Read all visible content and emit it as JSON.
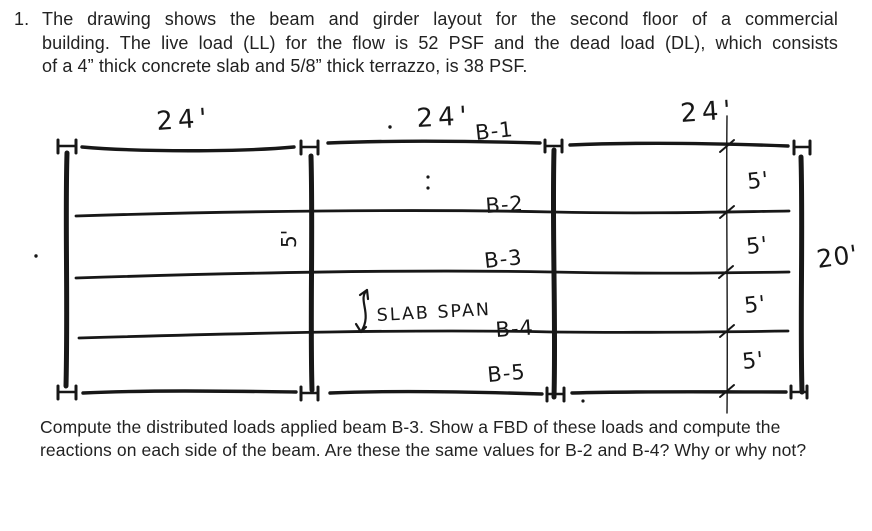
{
  "problem": {
    "number": "1.",
    "lines": [
      "The drawing shows the beam and girder layout for the second floor of a commercial",
      "building.  The live load (LL) for the flow is 52 PSF and the dead load (DL), which consists",
      "of a 4” thick concrete slab and 5/8” thick terrazzo, is 38 PSF."
    ]
  },
  "question": {
    "lines": [
      "Compute the distributed loads applied beam B-3. Show a FBD of these loads and compute the",
      "reactions on each side of the beam.  Are these the same values for B-2 and B-4?  Why or why not?"
    ]
  },
  "diagram": {
    "span_dims": [
      "24'",
      "24'",
      "24'"
    ],
    "beams": [
      "B-1",
      "B-2",
      "B-3",
      "B-4",
      "B-5"
    ],
    "bay_dims": [
      "5'",
      "5'",
      "5'",
      "5'"
    ],
    "girder_bay_dim": "5'",
    "depth_dim": "20'",
    "slab_span": "SLAB SPAN"
  },
  "colors": {
    "ink": "#171717",
    "paper": "#ffffff"
  }
}
